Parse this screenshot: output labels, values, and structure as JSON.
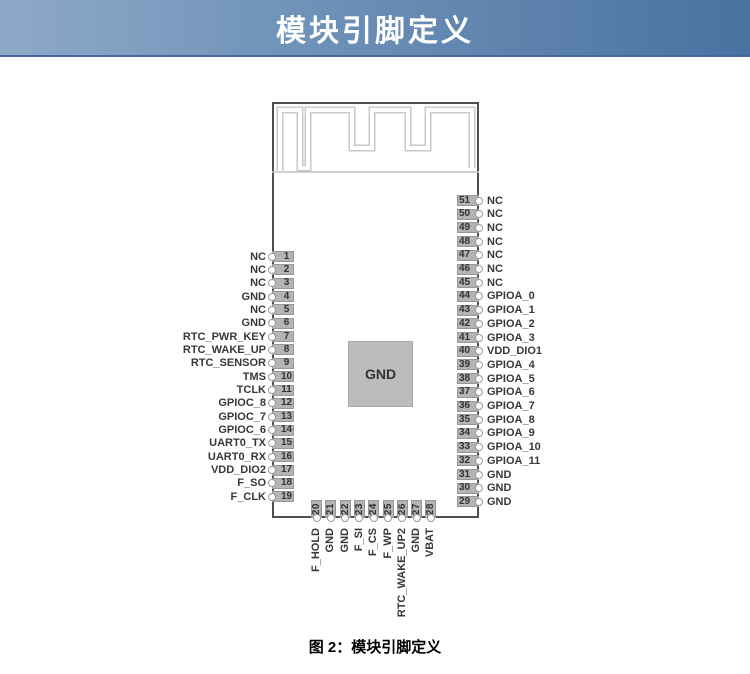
{
  "header": {
    "title": "模块引脚定义"
  },
  "caption": "图 2：模块引脚定义",
  "module": {
    "center_pad_label": "GND",
    "left_pins": [
      {
        "num": 1,
        "label": "NC"
      },
      {
        "num": 2,
        "label": "NC"
      },
      {
        "num": 3,
        "label": "NC"
      },
      {
        "num": 4,
        "label": "GND"
      },
      {
        "num": 5,
        "label": "NC"
      },
      {
        "num": 6,
        "label": "GND"
      },
      {
        "num": 7,
        "label": "RTC_PWR_KEY"
      },
      {
        "num": 8,
        "label": "RTC_WAKE_UP"
      },
      {
        "num": 9,
        "label": "RTC_SENSOR"
      },
      {
        "num": 10,
        "label": "TMS"
      },
      {
        "num": 11,
        "label": "TCLK"
      },
      {
        "num": 12,
        "label": "GPIOC_8"
      },
      {
        "num": 13,
        "label": "GPIOC_7"
      },
      {
        "num": 14,
        "label": "GPIOC_6"
      },
      {
        "num": 15,
        "label": "UART0_TX"
      },
      {
        "num": 16,
        "label": "UART0_RX"
      },
      {
        "num": 17,
        "label": "VDD_DIO2"
      },
      {
        "num": 18,
        "label": "F_SO"
      },
      {
        "num": 19,
        "label": "F_CLK"
      }
    ],
    "right_pins": [
      {
        "num": 51,
        "label": "NC"
      },
      {
        "num": 50,
        "label": "NC"
      },
      {
        "num": 49,
        "label": "NC"
      },
      {
        "num": 48,
        "label": "NC"
      },
      {
        "num": 47,
        "label": "NC"
      },
      {
        "num": 46,
        "label": "NC"
      },
      {
        "num": 45,
        "label": "NC"
      },
      {
        "num": 44,
        "label": "GPIOA_0"
      },
      {
        "num": 43,
        "label": "GPIOA_1"
      },
      {
        "num": 42,
        "label": "GPIOA_2"
      },
      {
        "num": 41,
        "label": "GPIOA_3"
      },
      {
        "num": 40,
        "label": "VDD_DIO1"
      },
      {
        "num": 39,
        "label": "GPIOA_4"
      },
      {
        "num": 38,
        "label": "GPIOA_5"
      },
      {
        "num": 37,
        "label": "GPIOA_6"
      },
      {
        "num": 36,
        "label": "GPIOA_7"
      },
      {
        "num": 35,
        "label": "GPIOA_8"
      },
      {
        "num": 34,
        "label": "GPIOA_9"
      },
      {
        "num": 33,
        "label": "GPIOA_10"
      },
      {
        "num": 32,
        "label": "GPIOA_11"
      },
      {
        "num": 31,
        "label": "GND"
      },
      {
        "num": 30,
        "label": "GND"
      },
      {
        "num": 29,
        "label": "GND"
      }
    ],
    "bottom_pins": [
      {
        "num": 20,
        "label": "F_HOLD"
      },
      {
        "num": 21,
        "label": "GND"
      },
      {
        "num": 22,
        "label": "GND"
      },
      {
        "num": 23,
        "label": "F_SI"
      },
      {
        "num": 24,
        "label": "F_CS"
      },
      {
        "num": 25,
        "label": "F_WP"
      },
      {
        "num": 26,
        "label": "RTC_WAKE_UP2"
      },
      {
        "num": 27,
        "label": "GND"
      },
      {
        "num": 28,
        "label": "VBAT"
      }
    ]
  },
  "colors": {
    "header_gradient_from": "#8ea9c8",
    "header_gradient_to": "#4a72a1",
    "pin_fill": "#b4b4b4",
    "pin_border": "#979797",
    "module_border": "#4f4f4f",
    "antenna_trace": "#c9c9c9",
    "label_text": "#383838"
  }
}
